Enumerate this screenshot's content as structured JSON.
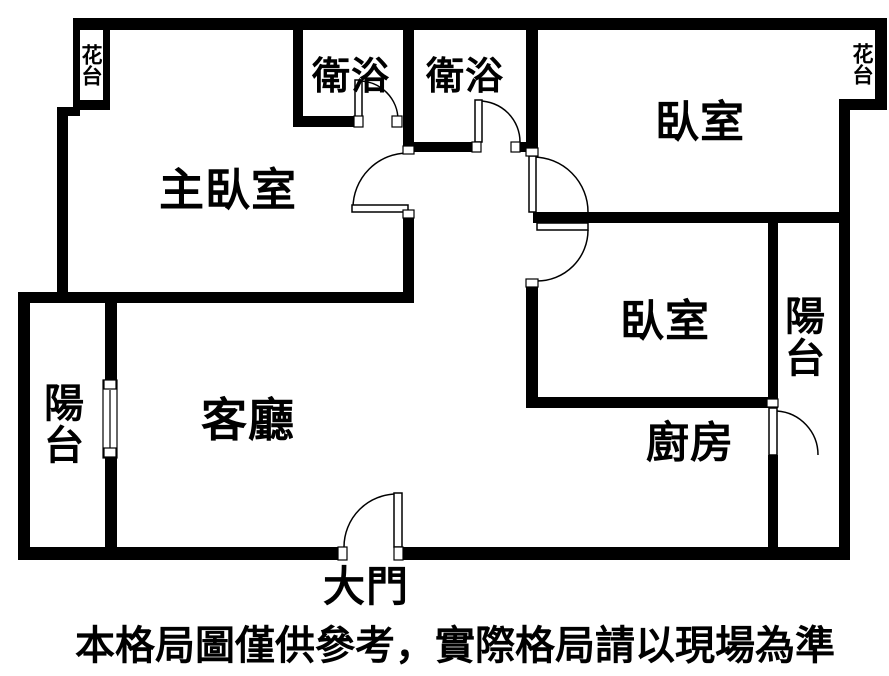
{
  "colors": {
    "wall": "#000000",
    "background": "#ffffff",
    "text": "#000000"
  },
  "labels": {
    "flower_bed_left": "花台",
    "flower_bed_right": "花台",
    "bathroom_left": "衛浴",
    "bathroom_right": "衛浴",
    "bedroom_top_right": "臥室",
    "master_bedroom": "主臥室",
    "bedroom_middle_right": "臥室",
    "balcony_left": "陽台",
    "balcony_right": "陽台",
    "living_room": "客廳",
    "kitchen": "廚房",
    "main_door": "大門",
    "disclaimer": "本格局圖僅供參考，實際格局請以現場為準"
  }
}
